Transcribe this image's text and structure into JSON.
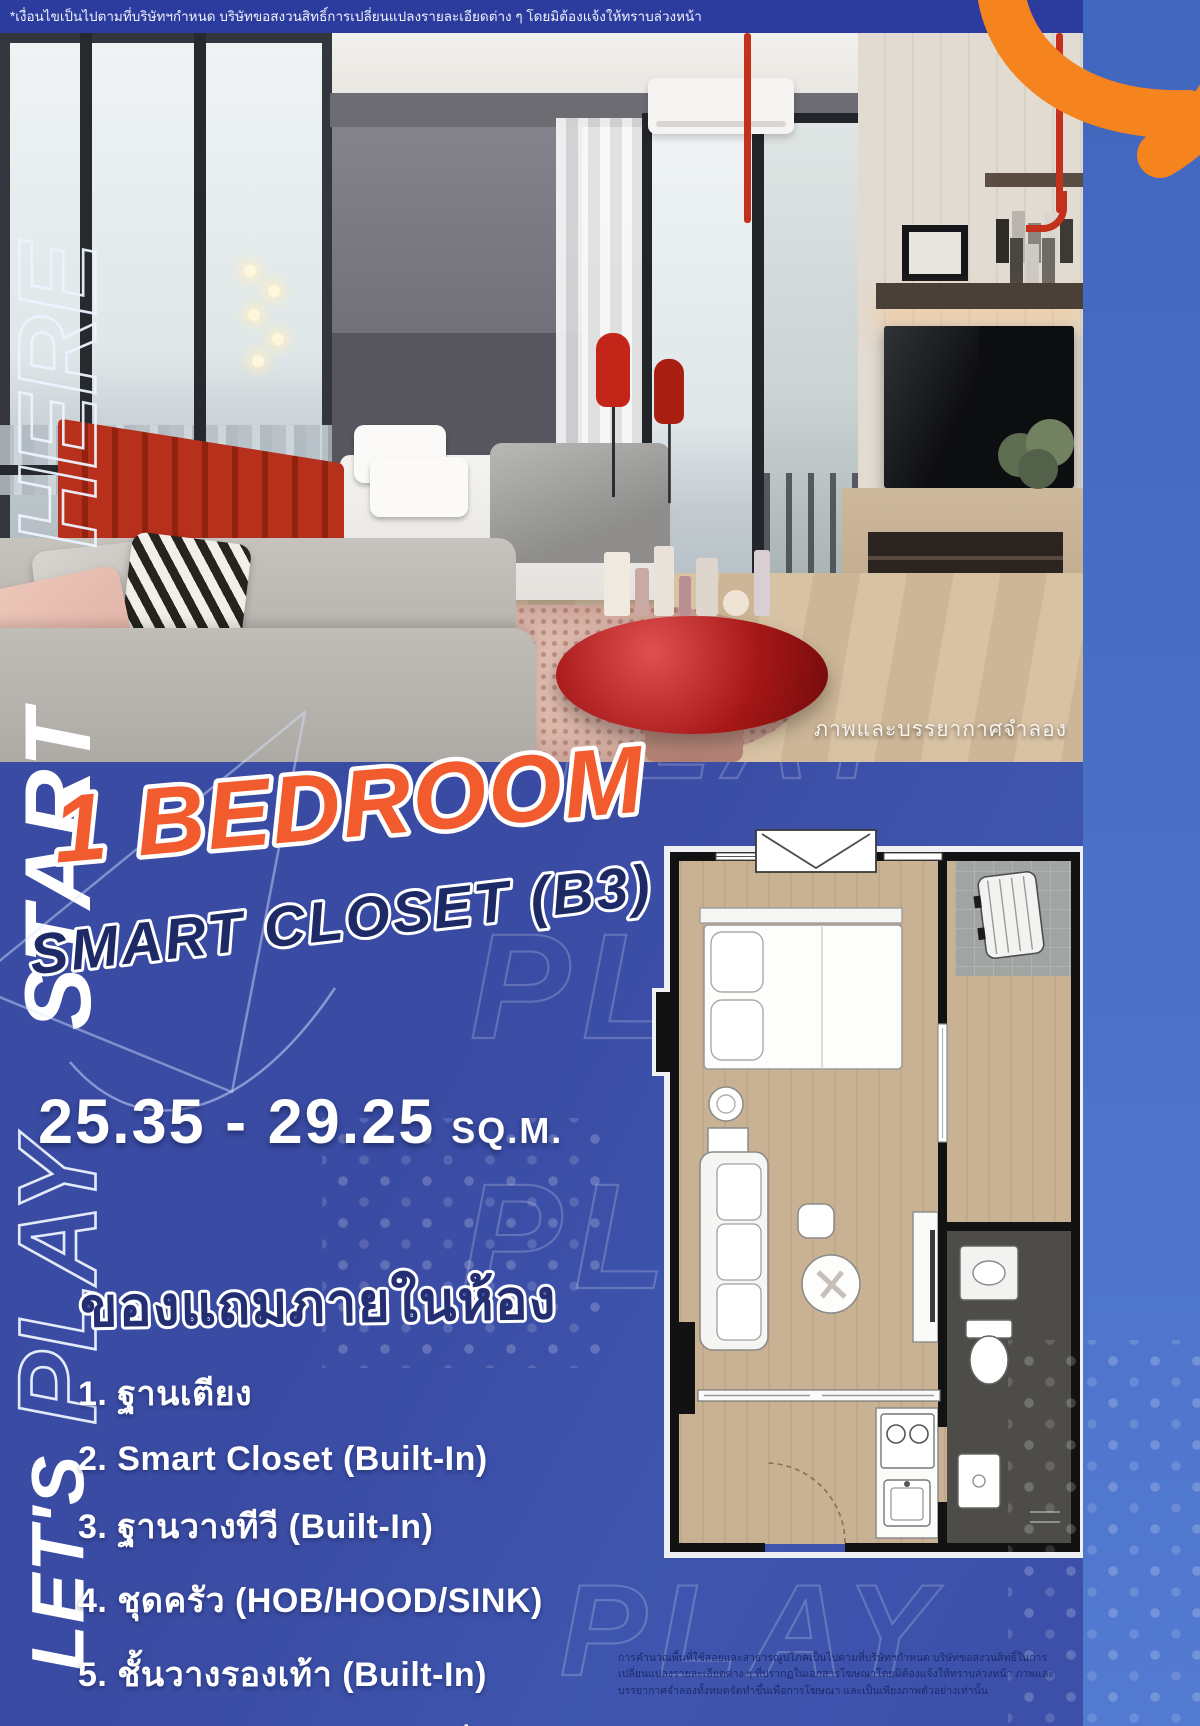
{
  "top_disclaimer": "*เงื่อนไขเป็นไปตามที่บริษัทฯกำหนด บริษัทขอสงวนสิทธิ์การเปลี่ยนแปลงรายละเอียดต่าง ๆ โดยมิต้องแจ้งให้ทราบล่วงหน้า",
  "photo": {
    "caption": "ภาพและบรรยากาศจำลอง"
  },
  "headline": {
    "line1": "1 BEDROOM",
    "line2": "SMART CLOSET (B3)"
  },
  "size": {
    "range": "25.35 - 29.25",
    "unit": "SQ.M."
  },
  "freebies": {
    "title": "ของแถมภายในห้อง",
    "items": [
      "1. ฐานเตียง",
      "2. Smart Closet (Built-In)",
      "3. ฐานวางทีวี (Built-In)",
      "4. ชุดครัว (HOB/HOOD/SINK)",
      "5. ชั้นวางรองเท้า (Built-In)",
      "6. แอร์ (12000 BTU 1 เครื่อง)"
    ]
  },
  "side_banner": {
    "word_lets": "LET'S",
    "word_play": "PLAY",
    "word_start": "START",
    "word_here": "HERE"
  },
  "watermark": "PLAY",
  "bottom_disclaimer": "การคำนวณพื้นที่ใช้สอยและสาธารณูปโภคเป็นไปตามที่บริษัทฯกำหนด บริษัทขอสงวนสิทธิ์ในการเปลี่ยนแปลงรายละเอียดต่าง ๆ ที่ปรากฏในเอกสารโฆษณาโดยมิต้องแจ้งให้ทราบล่วงหน้า ภาพและบรรยากาศจำลองทั้งหมดจัดทำขึ้นเพื่อการโฆษณา และเป็นเพียงภาพตัวอย่างเท่านั้น",
  "colors": {
    "background_blue": "#3b4da6",
    "band_blue": "#4a70c6",
    "accent_orange": "#f5841f",
    "headline_orange": "#f15b2d",
    "navy": "#1d2a66"
  }
}
